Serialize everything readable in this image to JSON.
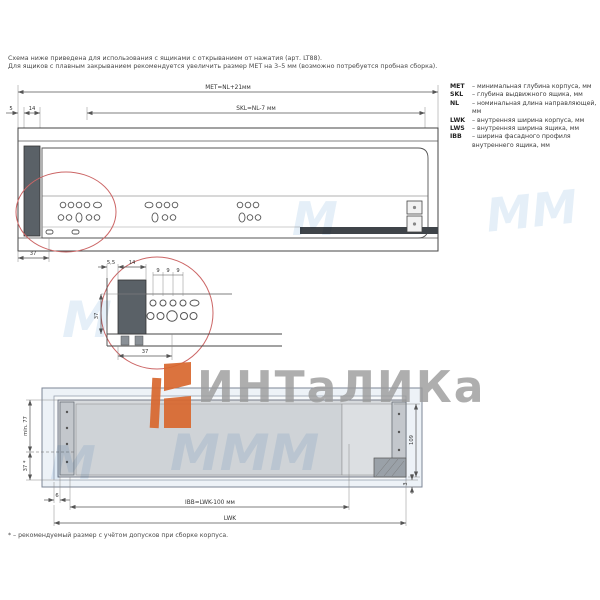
{
  "note": {
    "line1": "Схема ниже приведена для использования с ящиками с открыванием от нажатия (арт. LT88).",
    "line2": "Для ящиков с плавным закрыванием рекомендуется увеличить размер MET на 3–5 мм (возможно потребуется пробная сборка)."
  },
  "legend": {
    "items": [
      {
        "key": "MET",
        "desc": "– минимальная глубина корпуса, мм"
      },
      {
        "key": "SKL",
        "desc": "– глубина выдвижного ящика, мм"
      },
      {
        "key": "NL",
        "desc": "– номинальная длина направляющей, мм"
      },
      {
        "key": "LWK",
        "desc": "– внутренняя ширина корпуса, мм"
      },
      {
        "key": "LWS",
        "desc": "– внутренняя ширина ящика, мм"
      },
      {
        "key": "IBB",
        "desc": "– ширина фасадного профиля внутреннего ящика, мм"
      }
    ]
  },
  "plan_view": {
    "dim_met": "MET=NL+21мм",
    "dim_skl": "SKL=NL-7 мм",
    "dim_front_gap": "5",
    "dim_profile": "14",
    "dim_first_hole": "37"
  },
  "detail_view": {
    "dim_gap": "5,5",
    "dim_profile": "14",
    "dim_pitch_1": "9",
    "dim_pitch_2": "9",
    "dim_pitch_3": "9",
    "dim_height": "37",
    "dim_offset": "37"
  },
  "front_view": {
    "dim_min_height": "min. 77",
    "dim_rail_height": "37 *",
    "dim_side_gap": "6",
    "dim_ibb": "IBB=LWK-100 мм",
    "dim_lwk": "LWK",
    "dim_right_height": "109",
    "dim_bottom_gap": "3"
  },
  "footnote": "* – рекомендуемый размер с учётом допусков при сборке корпуса.",
  "watermark": {
    "brand": "ИНТаЛИКа",
    "accent_color": "#d9682e",
    "text_color": "#9b9b9b",
    "tint_color": "#cfe2f2",
    "marks": {
      "m1": "ММ",
      "m2": "М",
      "m3": "МММ",
      "m4": "М",
      "m5": "М"
    }
  }
}
